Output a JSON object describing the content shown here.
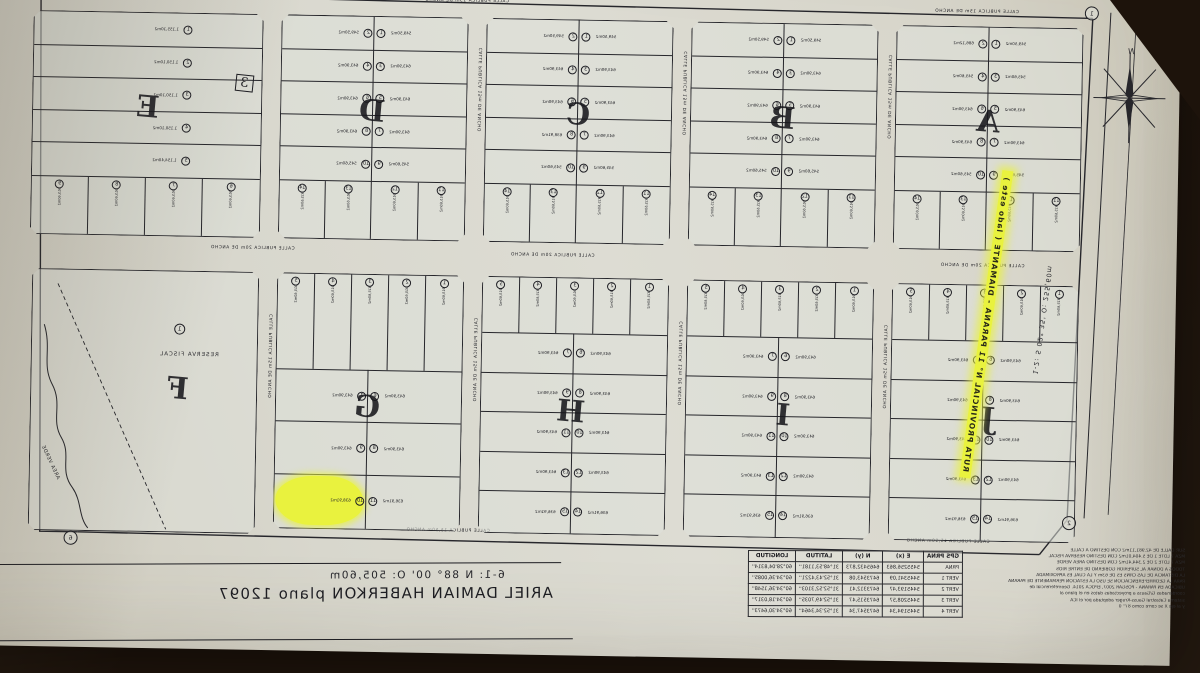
{
  "photo": {
    "background": "#1d130b",
    "paper": "#d8d6cb",
    "ink": "#26262b",
    "highlight": "#e9f23e"
  },
  "compass": {
    "north_label": "N"
  },
  "route": {
    "label": "RUTA PROVINCIAL N° 11  PARANA - DIAMANTE ( lado este )",
    "measure": "1-2: S 02° 35' O: 255,60m"
  },
  "boundaries": {
    "east_measure": "5-6: S 02° 13' O: 255,88m",
    "south_measure": "6-1: N 88° 00' O: 505,60m"
  },
  "title": {
    "plan_title": "ARIEL DAMIAN HABERKON  plano 12097"
  },
  "streets": {
    "top": "CALLE PUBLICA 15m DE ANCHO",
    "middle": "CALLE PUBLICA 20m DE ANCHO",
    "bottom": "CALLE PUBLICA 15,50m ANCHO",
    "vertical": "CALLE PUBLICA 15m DE ANCHO"
  },
  "vertices": {
    "v1": "1",
    "v2": "2",
    "v5": "5",
    "v6": "6"
  },
  "reserve_parcel": {
    "letter": "F",
    "lot_number": "1",
    "label": "RESERVA FISCAL",
    "green_area_label": "AREA VERDE"
  },
  "highlighted_lot": {
    "block": "G",
    "number": "10",
    "area": "638,91m2"
  },
  "top_blocks": [
    {
      "letter": "A",
      "dim": "57,50",
      "pair_rows": [
        [
          "1",
          "549,50m2",
          "2",
          "686,12m2"
        ],
        [
          "3",
          "545,60m2",
          "4",
          "545,60m2"
        ],
        [
          "5",
          "643,90m2",
          "6",
          "643,90m2"
        ],
        [
          "7",
          "643,90m2",
          "8",
          "643,90m2"
        ],
        [
          "9",
          "545,60m2",
          "10",
          "545,60m2"
        ]
      ],
      "strip": [
        "11",
        "12",
        "13",
        "14"
      ],
      "strip_dim": "915,60m2"
    },
    {
      "letter": "B",
      "dim": "57,50",
      "pair_rows": [
        [
          "1",
          "549,50m2",
          "2",
          "549,50m2"
        ],
        [
          "3",
          "643,90m2",
          "4",
          "643,90m2"
        ],
        [
          "5",
          "643,90m2",
          "6",
          "643,90m2"
        ],
        [
          "7",
          "643,90m2",
          "8",
          "643,90m2"
        ],
        [
          "9",
          "545,60m2",
          "10",
          "545,60m2"
        ]
      ],
      "strip": [
        "11",
        "12",
        "13",
        "14"
      ],
      "strip_dim": "915,60m2"
    },
    {
      "letter": "C",
      "dim": "57,50",
      "pair_rows": [
        [
          "1",
          "549,50m2",
          "2",
          "549,50m2"
        ],
        [
          "3",
          "643,90m2",
          "4",
          "643,90m2"
        ],
        [
          "5",
          "643,90m2",
          "6",
          "643,90m2"
        ],
        [
          "7",
          "643,90m2",
          "8",
          "638,91m2"
        ],
        [
          "9",
          "545,60m2",
          "10",
          "545,60m2"
        ]
      ],
      "strip": [
        "11",
        "12",
        "13",
        "14"
      ],
      "strip_dim": "915,60m2"
    },
    {
      "letter": "D",
      "dim": "57,50",
      "pair_rows": [
        [
          "1",
          "549,50m2",
          "2",
          "549,50m2"
        ],
        [
          "3",
          "643,90m2",
          "4",
          "643,90m2"
        ],
        [
          "5",
          "643,90m2",
          "6",
          "643,90m2"
        ],
        [
          "7",
          "643,90m2",
          "8",
          "643,90m2"
        ],
        [
          "9",
          "545,60m2",
          "10",
          "545,60m2"
        ]
      ],
      "strip": [
        "11",
        "12",
        "13",
        "14"
      ],
      "strip_dim": "915,60m2"
    },
    {
      "letter": "E",
      "dim": "57,50",
      "single_rows": [
        [
          "1",
          "1.155,10m2"
        ],
        [
          "2",
          "1.150,10m2"
        ],
        [
          "3",
          "1.150,10m2"
        ],
        [
          "4",
          "1.150,10m2"
        ],
        [
          "5",
          "1.154,40m2"
        ]
      ],
      "strip": [
        "6",
        "7",
        "8",
        "9"
      ],
      "strip_dim": "915,60m2",
      "annotation": "3"
    }
  ],
  "bottom_blocks": [
    {
      "letter": "J",
      "dim": "57,50",
      "strip": [
        "1",
        "2",
        "3",
        "4",
        "5"
      ],
      "pair_rows": [
        [
          "6",
          "643,90m2",
          "7",
          "643,90m2"
        ],
        [
          "8",
          "643,90m2",
          "9",
          "643,90m2"
        ],
        [
          "10",
          "643,90m2",
          "11",
          "643,90m2"
        ],
        [
          "12",
          "643,90m2",
          "13",
          "643,90m2"
        ],
        [
          "14",
          "636,91m2",
          "15",
          "636,91m2"
        ]
      ],
      "strip_dim": "915,60m2"
    },
    {
      "letter": "I",
      "dim": "57,50",
      "strip": [
        "1",
        "2",
        "3",
        "4",
        "5"
      ],
      "pair_rows": [
        [
          "6",
          "643,90m2",
          "7",
          "643,90m2"
        ],
        [
          "8",
          "643,90m2",
          "9",
          "643,90m2"
        ],
        [
          "10",
          "643,90m2",
          "11",
          "643,90m2"
        ],
        [
          "12",
          "643,90m2",
          "13",
          "643,90m2"
        ],
        [
          "14",
          "636,91m2",
          "15",
          "636,91m2"
        ]
      ],
      "strip_dim": "915,60m2"
    },
    {
      "letter": "H",
      "dim": "57,50",
      "strip": [
        "1",
        "2",
        "3",
        "4",
        "5"
      ],
      "pair_rows": [
        [
          "6",
          "643,90m2",
          "7",
          "643,90m2"
        ],
        [
          "8",
          "643,90m2",
          "9",
          "643,90m2"
        ],
        [
          "10",
          "643,90m2",
          "11",
          "643,90m2"
        ],
        [
          "12",
          "643,90m2",
          "13",
          "643,90m2"
        ],
        [
          "14",
          "636,91m2",
          "15",
          "636,91m2"
        ]
      ],
      "strip_dim": "915,60m2"
    },
    {
      "letter": "G",
      "dim": "57,50",
      "strip": [
        "1",
        "2",
        "3",
        "4",
        "5"
      ],
      "tall_strip": true,
      "pair_rows": [
        [
          "6",
          "643,90m2",
          "7",
          "643,90m2"
        ],
        [
          "8",
          "643,90m2",
          "9",
          "643,90m2"
        ],
        [
          "11",
          "636,91m2",
          "10",
          "638,91m2"
        ]
      ],
      "highlight_last_right": true,
      "strip_dim": "915,60m2"
    }
  ],
  "gps_table": {
    "corner_header": "GPS PRNA",
    "headers": [
      "E (x)",
      "N (y)",
      "LATITUD",
      "LONGITUD"
    ],
    "rows": [
      [
        "PRNA",
        "5455256,863",
        "6465432,873",
        "31°48'53,1181''",
        "60°28'04,8314''"
      ],
      [
        "VERT 1",
        "5445341,09",
        "6473543,08",
        "31°52'43,4221''",
        "60°34'36,0085''"
      ],
      [
        "VERT 2",
        "5445193,47",
        "6473312,41",
        "31°52'52,3103''",
        "60°34'36,1548''"
      ],
      [
        "VERT 3",
        "5445208,57",
        "6473515,47",
        "31°52'49,7035''",
        "60°34'18,0317''"
      ],
      [
        "VERT 4",
        "5445194,34",
        "6473547,34",
        "31°52'34,3464''",
        "60°34'30,6473''"
      ]
    ]
  },
  "notes": {
    "lines": [
      "SUP. CALLE DE 42.981,11m2  CON DESTINO A CALLE",
      "MZA 7 LOTE 1 DE 5.404,01m2 CON DESTINO RESERVA FISCAL",
      "MZA 7 LOTE 2 DE 2.344,41m2 CON DESTINO AREA VERDE",
      "TODOS A DONAR AL SUPERIOR GOBIERNO DE  ENTRE RIOS",
      "LA DISTANCIA DE LAS CRNS ES DE 63m  Y LA CUAL ES APROXIMADA",
      "PARA LA GEORREFERENCIACION SE USO LA ESTACION PERMANENTE DE PARANA",
      "UBICADA EN PARANA - POSGAR 2007, EPOCA 2014. Georreferencial de",
      "coordenadas G/Gauss a proyectadas datos en el plano al",
      "sistema Catastral Gauss-Kruger adoptada por el ICA",
      "y al eje X se corre como 87° 0"
    ]
  }
}
